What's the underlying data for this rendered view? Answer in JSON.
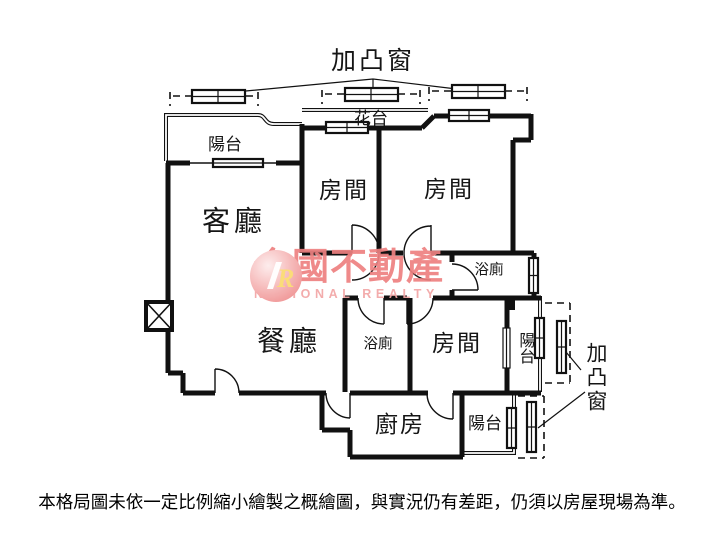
{
  "floorplan": {
    "bay_window_top": "加凸窗",
    "flower_stand": "花台",
    "balcony_top_left": "陽台",
    "living_room": "客廳",
    "bedroom_1": "房間",
    "bedroom_2": "房間",
    "bedroom_3": "房間",
    "bathroom_upper": "浴廁",
    "bathroom_lower": "浴廁",
    "dining_room": "餐廳",
    "kitchen": "廚房",
    "balcony_right": "陽台",
    "balcony_bottom": "陽台",
    "bay_window_right": "加凸窗"
  },
  "watermark": {
    "logo_letter": "R",
    "brand_name": "全國不動產",
    "brand_name_en": "NATIONAL REALTY",
    "brand_color": "#ee8181",
    "brand_color_light": "#f2a6a6"
  },
  "disclaimer": "本格局圖未依一定比例縮小繪製之概繪圖，與實況仍有差距，仍須以房屋現場為準。"
}
